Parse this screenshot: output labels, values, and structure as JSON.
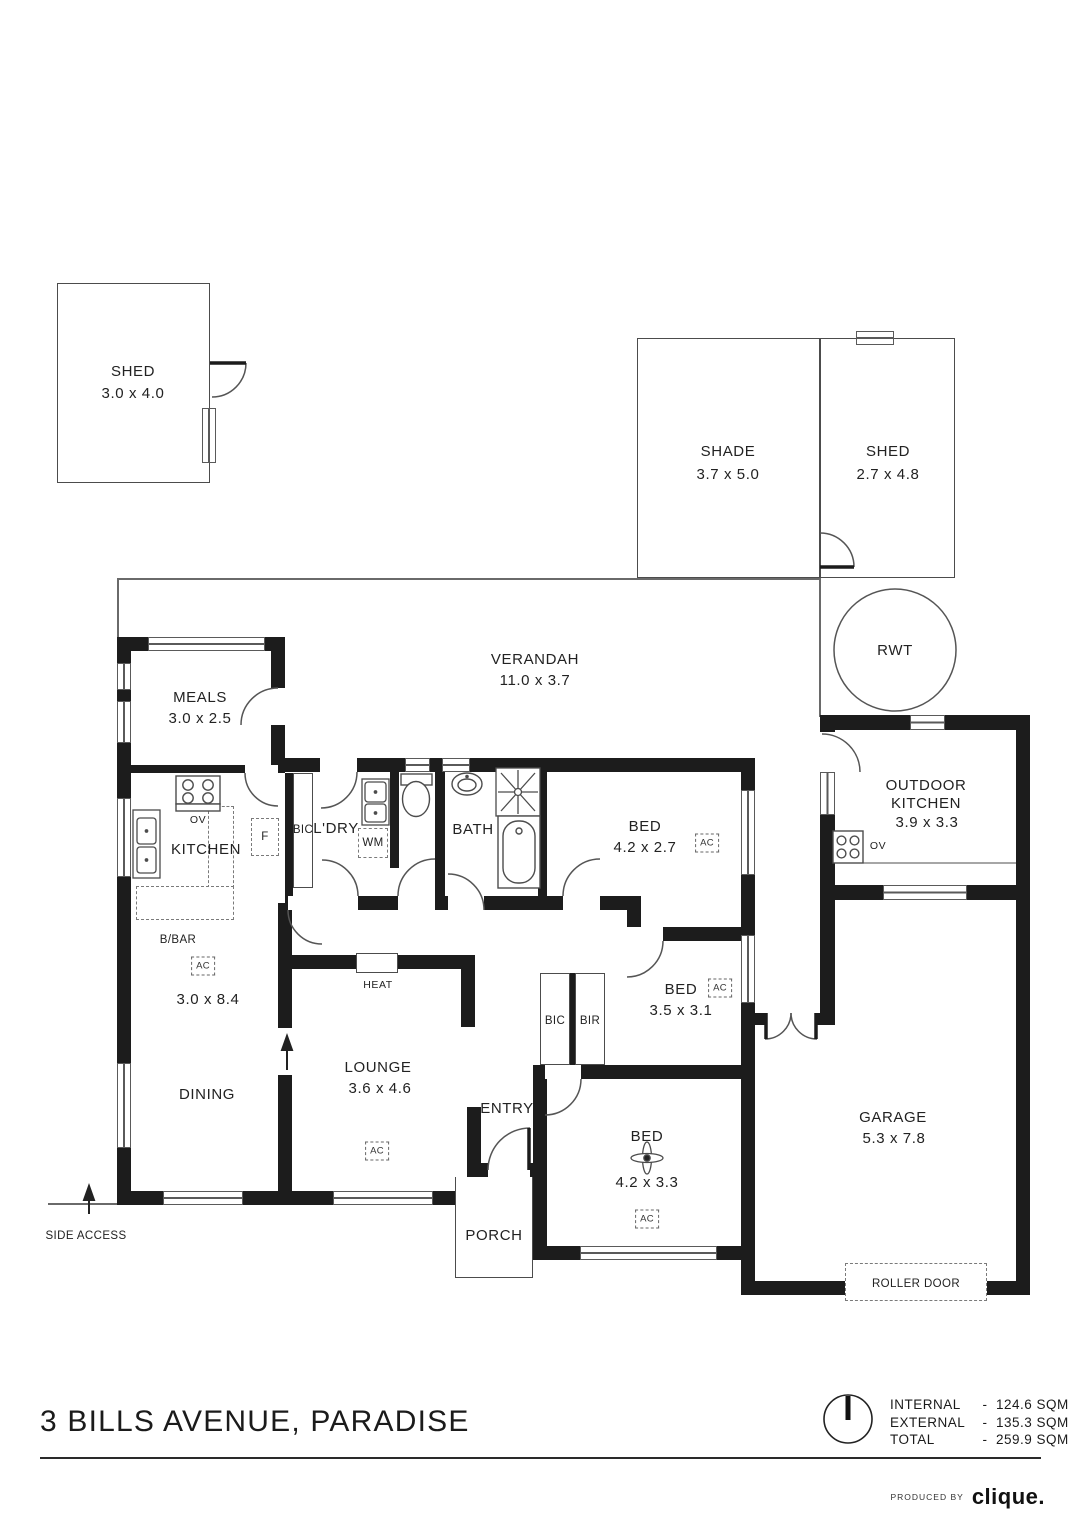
{
  "title": "3 BILLS AVENUE, PARADISE",
  "producer": {
    "prefix": "PRODUCED BY",
    "brand": "clique."
  },
  "areas": [
    {
      "label": "INTERNAL",
      "sep": "-",
      "value": "124.6 SQM"
    },
    {
      "label": "EXTERNAL",
      "sep": "-",
      "value": "135.3 SQM"
    },
    {
      "label": "TOTAL",
      "sep": "-",
      "value": "259.9 SQM"
    }
  ],
  "rooms": {
    "shed_left": {
      "name": "SHED",
      "dims": "3.0 x 4.0"
    },
    "shade": {
      "name": "SHADE",
      "dims": "3.7 x 5.0"
    },
    "shed_right": {
      "name": "SHED",
      "dims": "2.7 x 4.8"
    },
    "rwt": {
      "name": "RWT"
    },
    "verandah": {
      "name": "VERANDAH",
      "dims": "11.0 x 3.7"
    },
    "meals": {
      "name": "MEALS",
      "dims": "3.0 x 2.5"
    },
    "kitchen": {
      "name": "KITCHEN"
    },
    "kitchen_dining": {
      "dims": "3.0 x 8.4"
    },
    "dining": {
      "name": "DINING"
    },
    "lounge": {
      "name": "LOUNGE",
      "dims": "3.6 x 4.6"
    },
    "ldry": {
      "name": "L'DRY"
    },
    "bath": {
      "name": "BATH"
    },
    "bed1": {
      "name": "BED",
      "dims": "4.2 x 2.7"
    },
    "bed2": {
      "name": "BED",
      "dims": "3.5 x 3.1"
    },
    "bed3": {
      "name": "BED",
      "dims": "4.2 x 3.3"
    },
    "entry": {
      "name": "ENTRY"
    },
    "porch": {
      "name": "PORCH"
    },
    "garage": {
      "name": "GARAGE",
      "dims": "5.3 x 7.8"
    },
    "outdoor_kitchen": {
      "line1": "OUTDOOR",
      "line2": "KITCHEN",
      "dims": "3.9 x 3.3"
    }
  },
  "labels": {
    "ov": "OV",
    "f": "F",
    "wm": "WM",
    "bic": "BIC",
    "bir": "BIR",
    "bbar": "B/BAR",
    "ac": "AC",
    "heat": "HEAT",
    "roller_door": "ROLLER DOOR",
    "side_access": "SIDE ACCESS"
  }
}
